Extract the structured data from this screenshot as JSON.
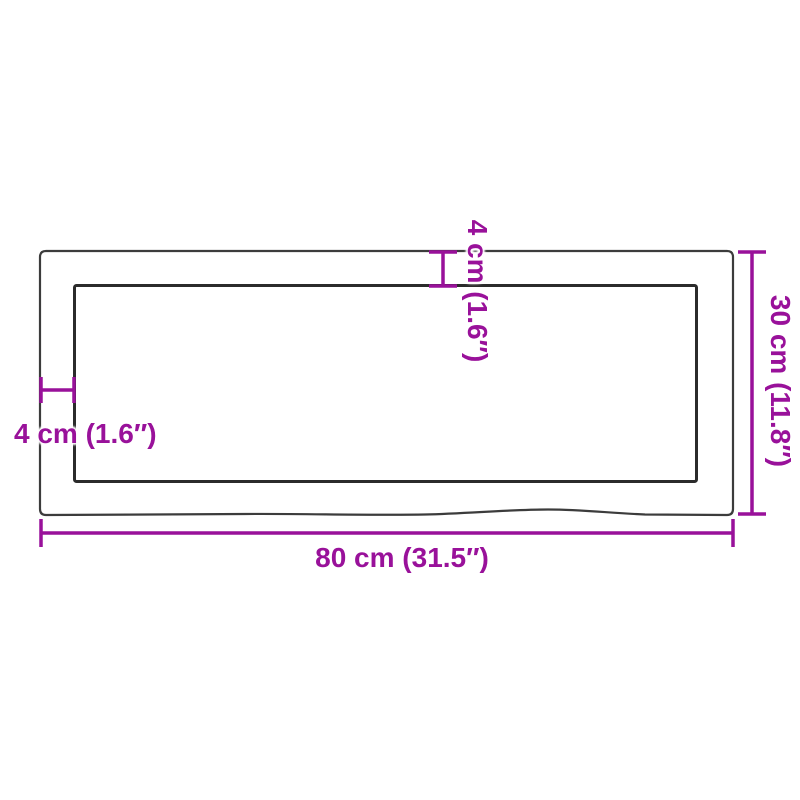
{
  "diagram": {
    "type": "product-dimension-drawing",
    "subject": "rectangular live-edge table top, top view",
    "labels": {
      "width": "80 cm (31.5″)",
      "height": "30 cm (11.8″)",
      "edge_left": "4 cm (1.6″)",
      "edge_top": "4 cm (1.6″)"
    },
    "colors": {
      "accent": "#99119A",
      "outline_outer": "#3C3C3C",
      "outline_inner": "#2B2B2B",
      "background": "#FFFFFF"
    }
  }
}
